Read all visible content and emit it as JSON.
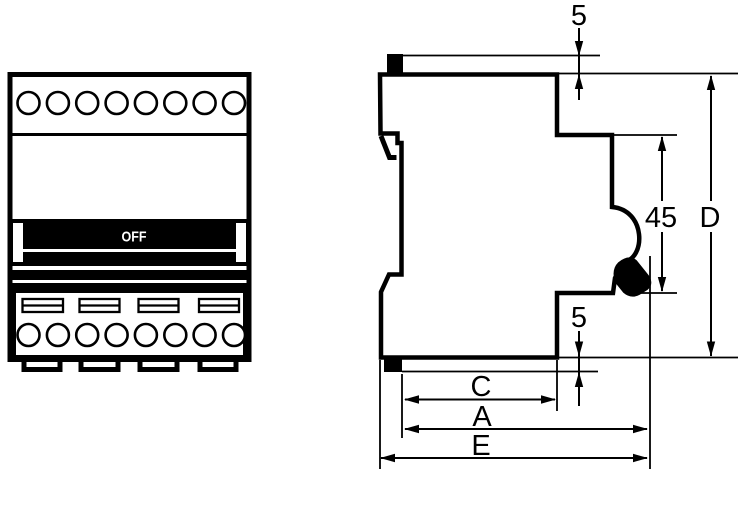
{
  "drawing": {
    "type": "dimension-drawing",
    "subject": "4-pole modular circuit breaker, front view and side profile view",
    "colors": {
      "line": "#000000",
      "background": "#ffffff"
    },
    "front_view": {
      "switch_label": "OFF",
      "top_terminal_count": 8,
      "bottom_terminal_count": 8,
      "slot_count": 4,
      "feet_count": 4
    },
    "side_view": {
      "dimensions": {
        "top_clip_offset": "5",
        "handle_recess_height": "45",
        "overall_height": "D",
        "bottom_clip_offset": "5",
        "depth_c": "C",
        "depth_a": "A",
        "depth_e": "E"
      }
    }
  }
}
